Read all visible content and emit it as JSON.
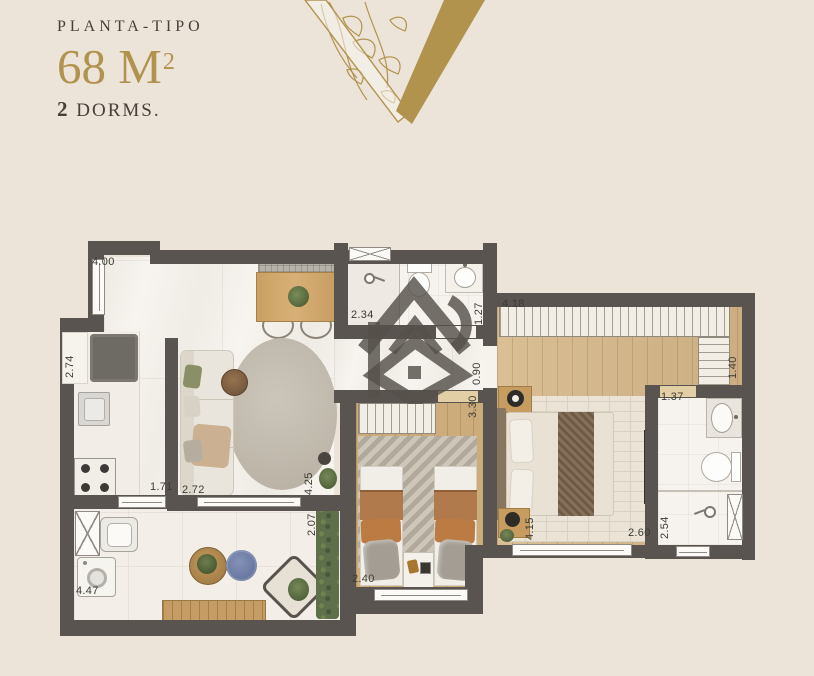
{
  "header": {
    "plan_label": "PLANTA-TIPO",
    "area_value": "68",
    "area_unit": "M",
    "area_exponent": "2",
    "dorms_number": "2",
    "dorms_label": "DORMS."
  },
  "colors": {
    "background": "#ece4d9",
    "wall": "#595450",
    "gold": "#b2934e",
    "title_text": "#474039",
    "dim_text": "#3e3a34",
    "marble": "#f7f4ef",
    "bath_floor": "#f6f3ee",
    "wood": "#d6b788",
    "wood2": "#cdac7c",
    "terrace_floor": "#f3efe8",
    "window_frame": "#8f8b84",
    "sofa": "#eae5dc",
    "rug": "#c3bcb0",
    "rug_master": "#eae3d6",
    "hedge": "#5d6f4b",
    "blue_pouf": "#6f7ca4",
    "brown_stripe": "#b17a4c",
    "orange": "#bd7b44",
    "pillow_gray": "#a39d93",
    "bed_headboard": "#87755f",
    "bed_runner": "#6f5942",
    "nightstand_wood": "#c69c60",
    "table_wood": "#c99f63",
    "plant_green": "#5f7048",
    "watermark": "rgba(86,81,74,0.82)"
  },
  "plan": {
    "dimensions": [
      {
        "value": "4.00"
      },
      {
        "value": "2.74"
      },
      {
        "value": "2.34"
      },
      {
        "value": "1.27"
      },
      {
        "value": "0.90"
      },
      {
        "value": "3.30"
      },
      {
        "value": "4.18"
      },
      {
        "value": "1.40"
      },
      {
        "value": "1.37"
      },
      {
        "value": "2.54"
      },
      {
        "value": "2.60"
      },
      {
        "value": "4.15"
      },
      {
        "value": "2.40"
      },
      {
        "value": "1.71"
      },
      {
        "value": "2.72"
      },
      {
        "value": "4.25"
      },
      {
        "value": "2.07"
      },
      {
        "value": "4.47"
      }
    ]
  }
}
